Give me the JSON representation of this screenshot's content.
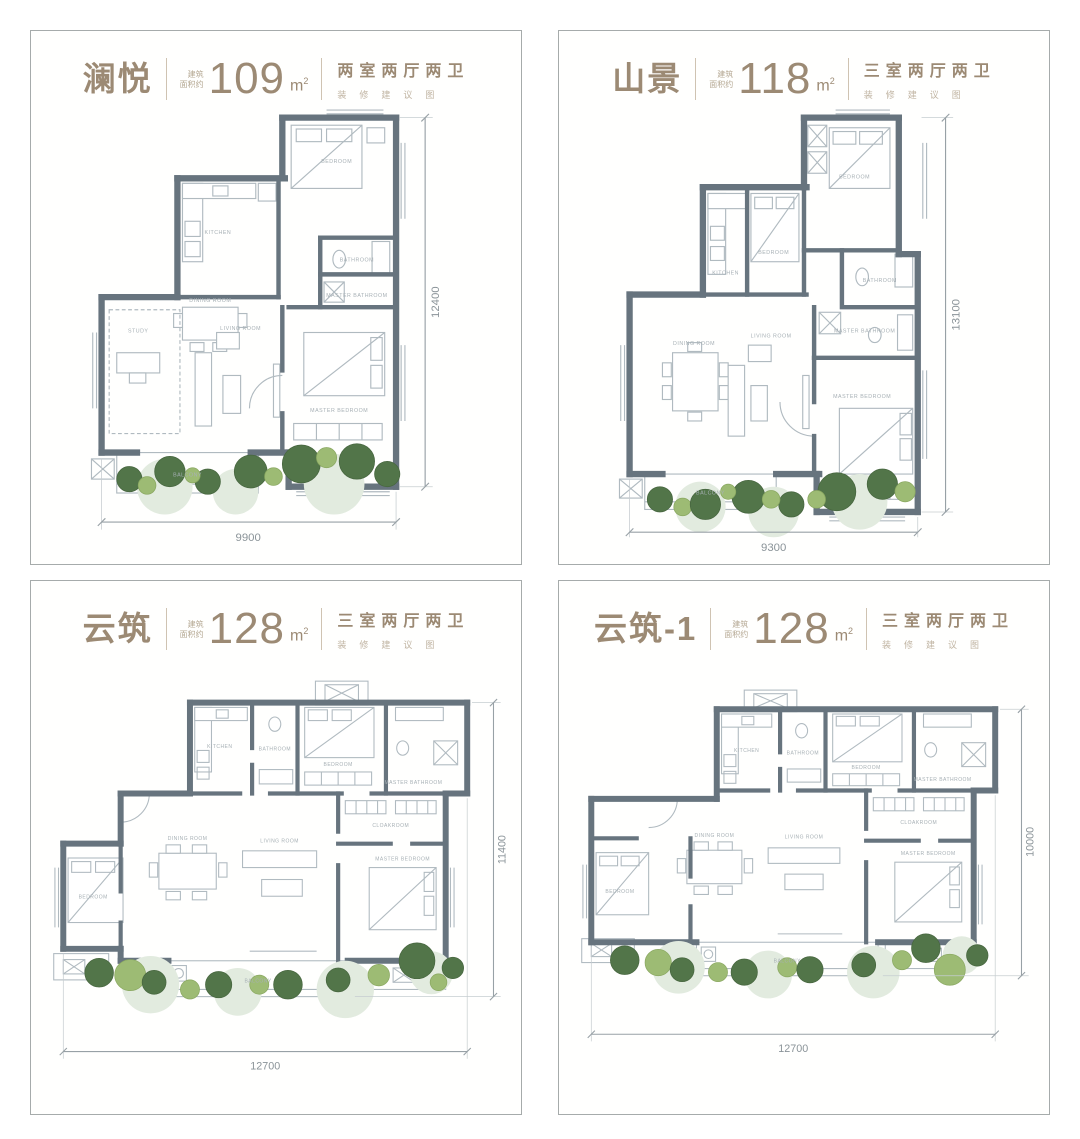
{
  "colors": {
    "title_text": "#9c8a74",
    "note_text": "#c0b4a2",
    "wall": "#67747e",
    "thin_line": "#b0bac0",
    "dimension": "#8a9398",
    "tree_dark": "#527549",
    "tree_light": "#9dbb74",
    "tree_pale": "#e2ebdf",
    "panel_border": "#a6abab"
  },
  "panels": [
    {
      "title": "澜悦",
      "area_about_1": "建筑",
      "area_about_2": "面积约",
      "area_value": "109",
      "area_unit": "m",
      "area_exp": "2",
      "layout": "两室两厅两卫",
      "note": "装修建议图",
      "dim_width": "9900",
      "dim_height": "12400",
      "labels": {
        "bedroom": "BEDROOM",
        "kitchen": "KITCHEN",
        "bathroom": "BATHROOM",
        "master_bathroom": "MASTER BATHROOM",
        "dining": "DINING ROOM",
        "living": "LIVING ROOM",
        "study": "STUDY",
        "master_bedroom": "MASTER BEDROOM",
        "balcony": "BALCONY"
      }
    },
    {
      "title": "山景",
      "area_about_1": "建筑",
      "area_about_2": "面积约",
      "area_value": "118",
      "area_unit": "m",
      "area_exp": "2",
      "layout": "三室两厅两卫",
      "note": "装修建议图",
      "dim_width": "9300",
      "dim_height": "13100",
      "labels": {
        "bedroom": "BEDROOM",
        "bedroom2": "BEDROOM",
        "kitchen": "KITCHEN",
        "bathroom": "BATHROOM",
        "master_bathroom": "MASTER BATHROOM",
        "dining": "DINING ROOM",
        "living": "LIVING ROOM",
        "master_bedroom": "MASTER BEDROOM",
        "balcony": "BALCONY"
      }
    },
    {
      "title": "云筑",
      "area_about_1": "建筑",
      "area_about_2": "面积约",
      "area_value": "128",
      "area_unit": "m",
      "area_exp": "2",
      "layout": "三室两厅两卫",
      "note": "装修建议图",
      "dim_width": "12700",
      "dim_height": "11400",
      "labels": {
        "kitchen": "KITCHEN",
        "bathroom": "BATHROOM",
        "bedroom": "BEDROOM",
        "master_bathroom": "MASTER BATHROOM",
        "cloakroom": "CLOAKROOM",
        "bedroom2": "BEDROOM",
        "dining": "DINING ROOM",
        "living": "LIVING ROOM",
        "master_bedroom": "MASTER BEDROOM",
        "balcony": "BALCONY"
      }
    },
    {
      "title": "云筑-1",
      "area_about_1": "建筑",
      "area_about_2": "面积约",
      "area_value": "128",
      "area_unit": "m",
      "area_exp": "2",
      "layout": "三室两厅两卫",
      "note": "装修建议图",
      "dim_width": "12700",
      "dim_height": "10000",
      "labels": {
        "kitchen": "KITCHEN",
        "bathroom": "BATHROOM",
        "bedroom": "BEDROOM",
        "master_bathroom": "MASTER BATHROOM",
        "cloakroom": "CLOAKROOM",
        "bedroom2": "BEDROOM",
        "dining": "DINING ROOM",
        "living": "LIVING ROOM",
        "master_bedroom": "MASTER BEDROOM",
        "balcony": "BALCONY"
      }
    }
  ]
}
